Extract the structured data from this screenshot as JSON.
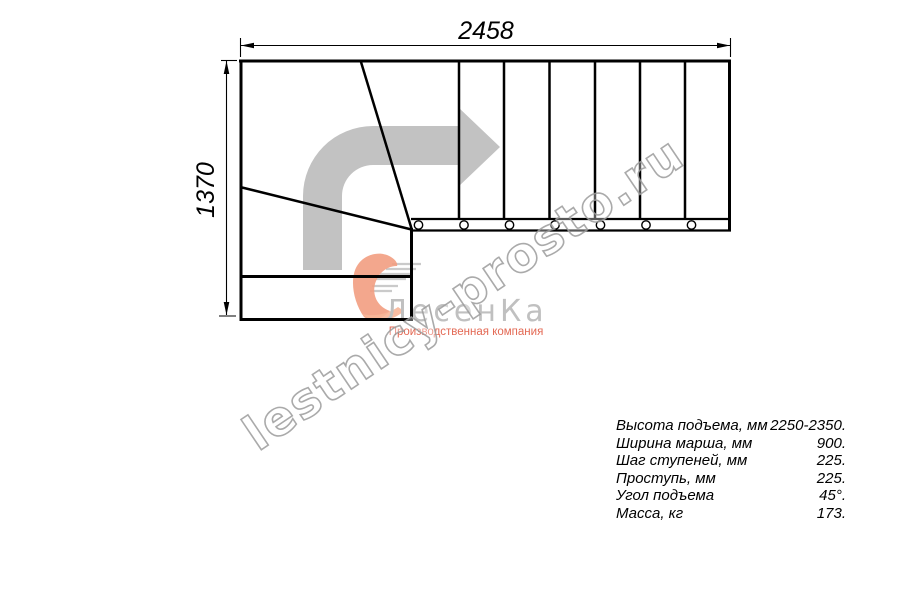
{
  "drawing": {
    "type": "stair-plan-top-view",
    "dimensions": {
      "width_mm": "2458",
      "height_mm": "1370"
    },
    "plan": {
      "straight_tread_count": 7,
      "baluster_count": 7,
      "winder_tread_lines": 2,
      "lower_flight_treads": 2,
      "turn_direction": "up-then-right"
    }
  },
  "specs": {
    "rows": [
      {
        "label": "Высота подъема, мм",
        "value": "2250-2350."
      },
      {
        "label": "Ширина марша, мм",
        "value": "900."
      },
      {
        "label": "Шаг ступеней, мм",
        "value": "225."
      },
      {
        "label": "Проступь, мм",
        "value": "225."
      },
      {
        "label": "Угол подъема",
        "value": "45°."
      },
      {
        "label": "Масса, кг",
        "value": "173."
      }
    ]
  },
  "watermark": {
    "text": "lestnicy-prosto.ru"
  },
  "logo": {
    "brand": "ЛесенКа",
    "tagline": "Производственная компания"
  },
  "colors": {
    "line": "#000000",
    "flow_arrow": "#c2c2c2",
    "watermark": "#9b9b9b",
    "logo_gray": "#bdbdbd",
    "logo_accent": "#e2604a",
    "logo_swoosh": "#f2997a"
  }
}
